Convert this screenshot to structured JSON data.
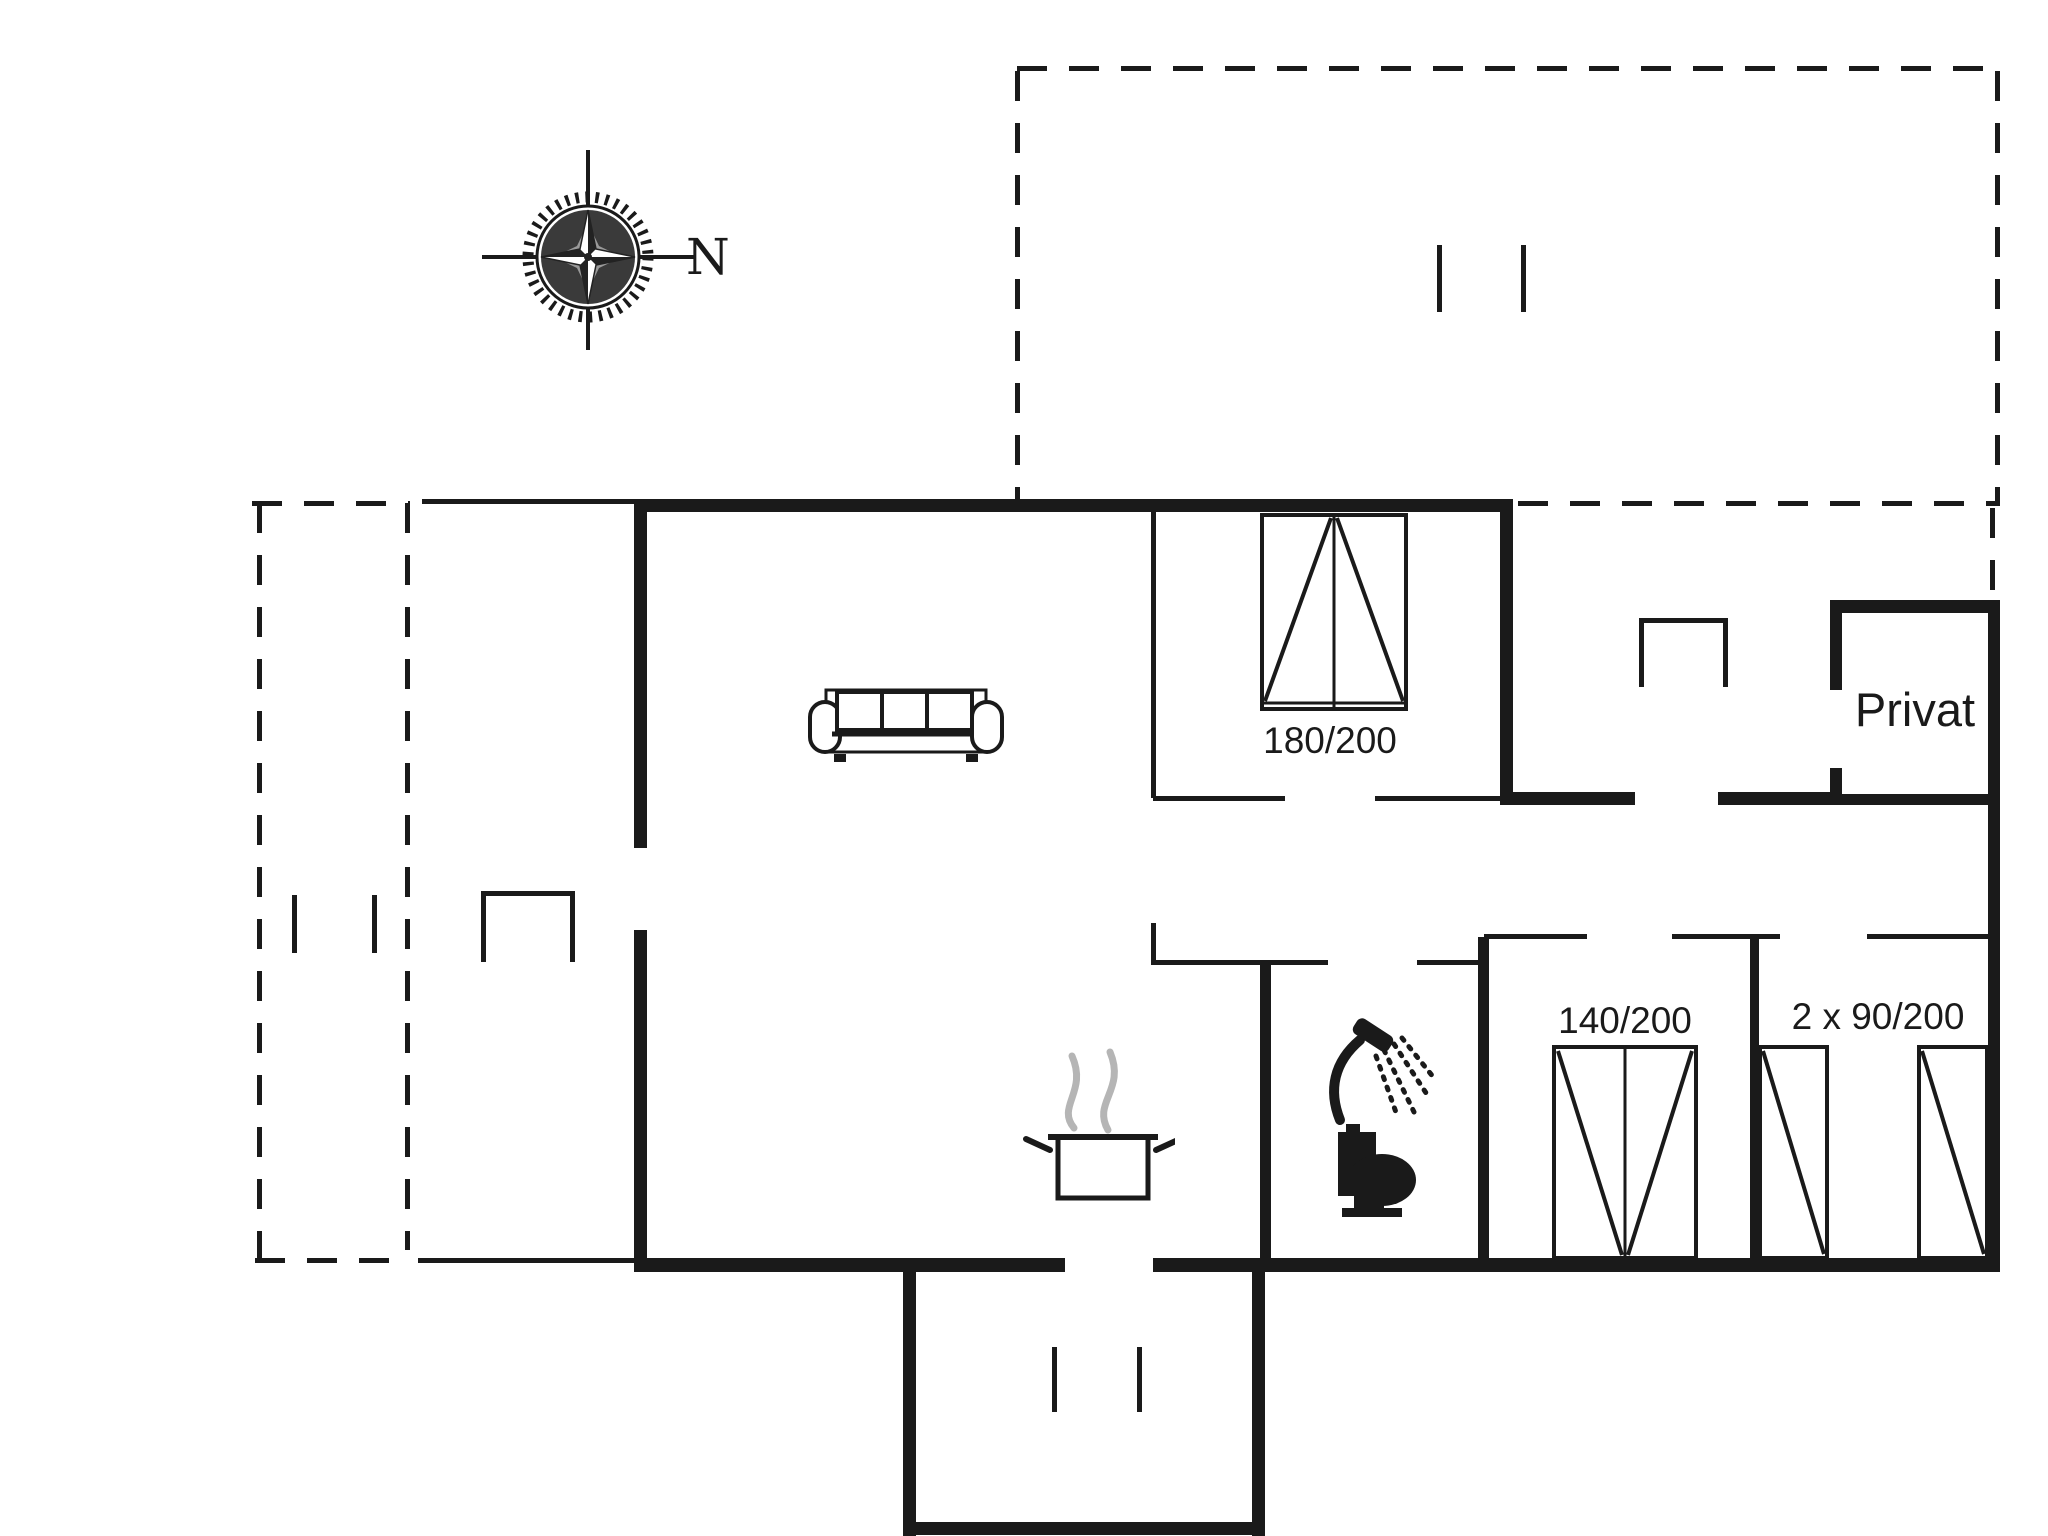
{
  "title": "Holiday house floor plan",
  "compass": {
    "label": "N"
  },
  "rooms": {
    "private_room_label": "Privat"
  },
  "beds": {
    "double_bed_label": "180/200",
    "bed_140_label": "140/200",
    "twin_beds_label": "2 x 90/200"
  },
  "icons": {
    "compass": "compass-rose-icon",
    "sofa": "sofa-icon",
    "stove": "cooking-pot-icon",
    "shower": "shower-icon",
    "toilet": "toilet-icon",
    "beds": "bed-symbol",
    "doors": "door-opening-bracket",
    "windows": "window-tick-marks"
  },
  "colors": {
    "ink": "#1a1a1a",
    "steam": "#b5b5b5",
    "bg": "#ffffff"
  }
}
